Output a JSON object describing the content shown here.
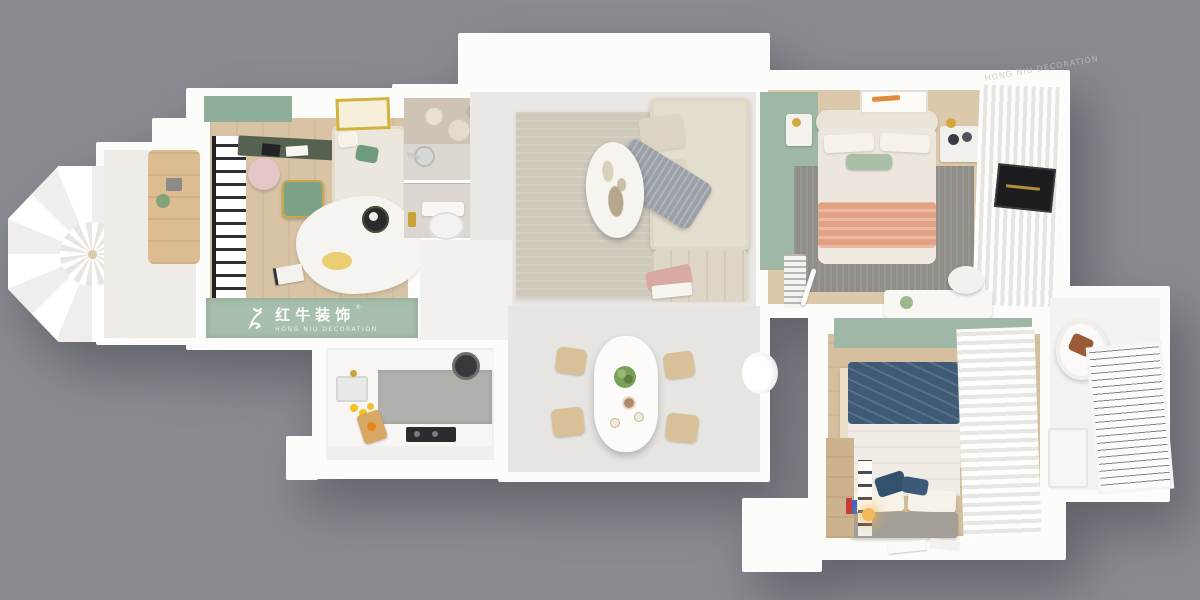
{
  "scene": {
    "description": "3D top-down floor plan render of an apartment on a gray backdrop",
    "background_color": "#8a8a91"
  },
  "watermark": {
    "brand_cn": "红牛装饰",
    "brand_en": "HONG NIU DECORATION",
    "registered_mark": "®",
    "band_color": "#a8bfae",
    "icon": "bull-icon"
  },
  "palette": {
    "wall_white": "#fcfcfb",
    "accent_green": "#9eb8a5",
    "wood_floor": "#d8c3a5",
    "living_rug_beige": "#cfc9bc",
    "master_rug_gray": "#908e88",
    "peach_blanket": "#e3a184",
    "navy_blanket": "#3e5a74",
    "lemon_yellow": "#f2c41d",
    "caramel_pillow": "#9a5a34",
    "gold_fixture": "#c9a238"
  },
  "rooms": [
    {
      "id": "balcony",
      "features": [
        "octagonal balcony",
        "white patio umbrella",
        "wood cabinet",
        "potted plant"
      ]
    },
    {
      "id": "study",
      "features": [
        "green accent cabinet",
        "desk with pink chair",
        "green armchair with gold frame",
        "cream loveseat with green pillow",
        "yellow framed artwork",
        "white freeform rug",
        "round black side table",
        "brand watermark band"
      ]
    },
    {
      "id": "bathroom-1",
      "features": [
        "marble shower zone",
        "glass partition",
        "shower head",
        "toilet",
        "gold fixtures"
      ]
    },
    {
      "id": "living-room",
      "features": [
        "beige area rug",
        "oval marble coffee table",
        "cream sectional sofa",
        "gray throw blanket",
        "blush blanket on ottoman"
      ]
    },
    {
      "id": "dining-room",
      "features": [
        "white rounded dining table",
        "four wooden chairs",
        "green plant centerpiece",
        "small cups"
      ]
    },
    {
      "id": "kitchen",
      "features": [
        "white U-shaped counters",
        "gray counter slab",
        "sink with gold faucet",
        "lemons",
        "wood cutting board",
        "dark cooktop",
        "wok"
      ]
    },
    {
      "id": "master-bedroom",
      "features": [
        "sage accent wall",
        "cream upholstered bed",
        "sage lumbar pillow",
        "peach blanket",
        "gray rug",
        "two nightstands with gold lamps",
        "framed orange artwork",
        "sheer-curtain wardrobe",
        "dark TV niche",
        "vanity desk with stool",
        "striped bench"
      ]
    },
    {
      "id": "bedroom-2",
      "features": [
        "sage accent wall",
        "bed with navy blanket",
        "cream rug with black cross pattern",
        "white curtains",
        "gray foot bench",
        "wood wardrobe",
        "warm bedside lamp",
        "papers on floor"
      ]
    },
    {
      "id": "bathroom-2",
      "features": [
        "white lounge chair",
        "caramel pillow",
        "white louvered blinds",
        "small cabinet"
      ]
    }
  ]
}
